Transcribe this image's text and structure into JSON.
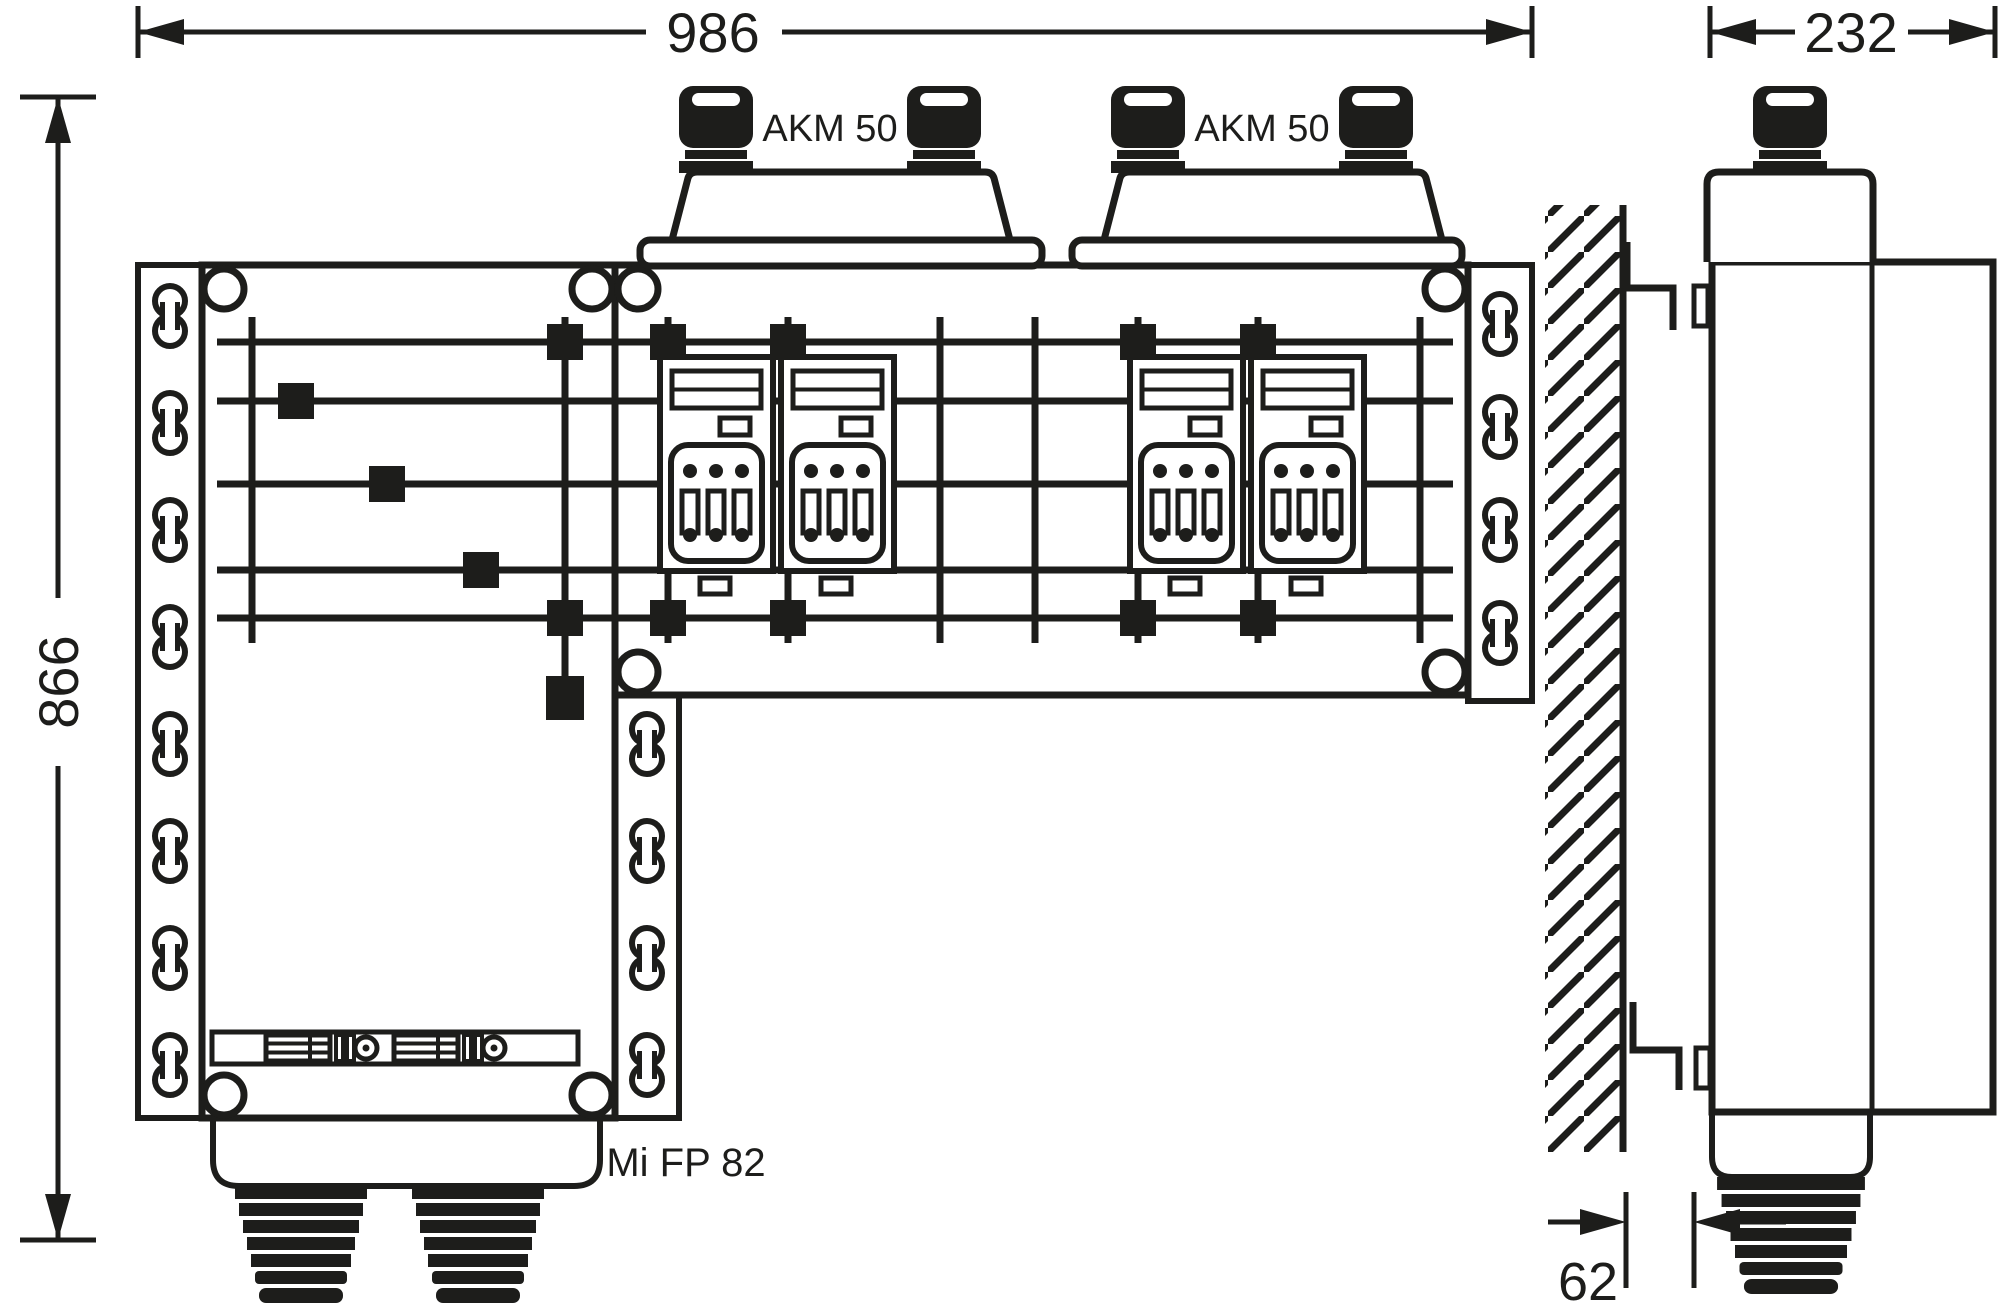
{
  "title": "Mi FP 82 distribution board dimensional drawing",
  "dimensions": {
    "front_width": "986",
    "front_height": "866",
    "side_depth": "232",
    "wall_clearance": "62"
  },
  "labels": {
    "hood_1": "AKM 50",
    "hood_2": "AKM 50",
    "product": "Mi FP 82"
  },
  "colors": {
    "line": "#1d1d1b",
    "background": "#ffffff"
  }
}
